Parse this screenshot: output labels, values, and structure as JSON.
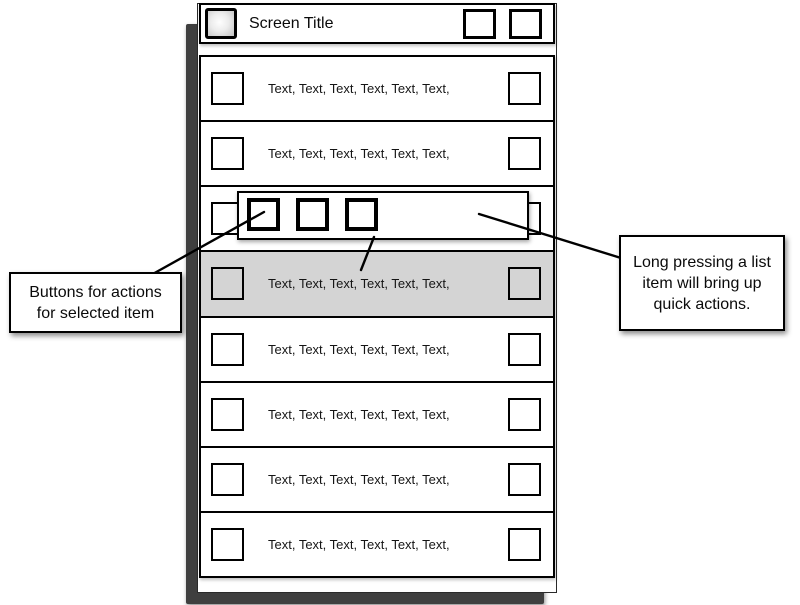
{
  "app": {
    "title_bar": {
      "title": "Screen Title",
      "app_icon": "gradient-square-icon",
      "buttons": [
        {
          "label": "",
          "icon": "square-placeholder-icon"
        },
        {
          "label": "",
          "icon": "square-placeholder-icon"
        }
      ]
    },
    "list": {
      "selected_index": 3,
      "rows": [
        {
          "text": "Text, Text, Text, Text, Text, Text,"
        },
        {
          "text": "Text, Text, Text, Text, Text, Text,"
        },
        {
          "text": "Text, Text, Text, Text, Text, Text,"
        },
        {
          "text": "Text, Text, Text, Text, Text, Text,"
        },
        {
          "text": "Text, Text, Text, Text, Text, Text,"
        },
        {
          "text": "Text, Text, Text, Text, Text, Text,"
        },
        {
          "text": "Text, Text, Text, Text, Text, Text,"
        },
        {
          "text": "Text, Text, Text, Text, Text, Text,"
        }
      ]
    },
    "popup": {
      "button_count": 3,
      "buttons": [
        {
          "icon": "square-action-icon"
        },
        {
          "icon": "square-action-icon"
        },
        {
          "icon": "square-action-icon"
        }
      ]
    },
    "callouts": {
      "left": {
        "line1": "Buttons for actions",
        "line2": "for selected item"
      },
      "right": {
        "line1": "Long pressing a list",
        "line2": "item will bring up",
        "line3": "quick actions."
      }
    },
    "colors": {
      "selected_row": "#d4d4d4",
      "frame_shadow": "#3f3f3f",
      "border": "#000000",
      "background": "#ffffff"
    }
  }
}
